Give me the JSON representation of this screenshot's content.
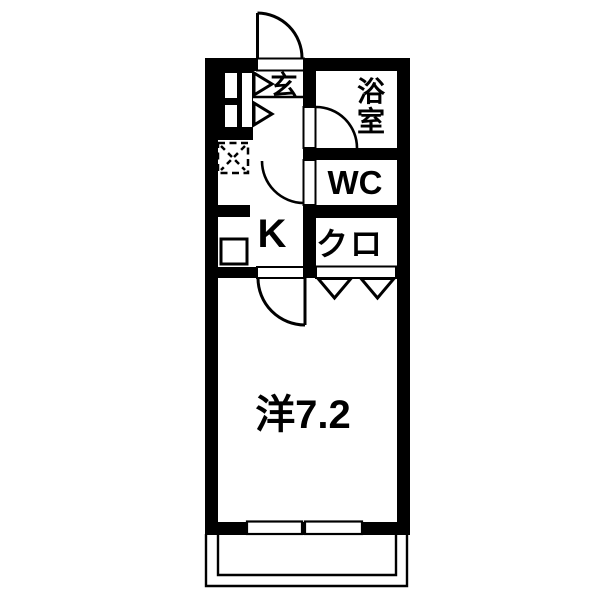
{
  "plan": {
    "type": "japanese-apartment-floor-plan",
    "colors": {
      "wall": "#000000",
      "background": "#ffffff",
      "line": "#000000"
    },
    "rooms": {
      "entrance": {
        "label": "玄"
      },
      "bathroom": {
        "label_top": "浴",
        "label_bottom": "室"
      },
      "toilet": {
        "label": "WC"
      },
      "kitchen": {
        "label": "K"
      },
      "closet": {
        "label": "クロ"
      },
      "western_room": {
        "label": "洋7.2"
      }
    }
  }
}
